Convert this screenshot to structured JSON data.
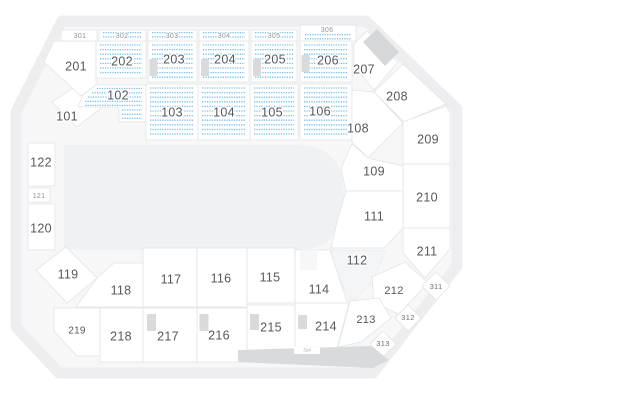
{
  "map": {
    "colors": {
      "page_background": "#ffffff",
      "ring_band": "#eeeef0",
      "interior": "#f7f7f8",
      "floor": "#f0f1f2",
      "section_fill": "#ffffff",
      "section_border": "#e3e4e6",
      "ghost_fill": "#f4f5f6",
      "available_dot": "#7bbfed",
      "tunnel": "#d8dadc",
      "stage_bar": "#d9dadb",
      "label_main": "#56585f",
      "label_small": "#8f9296",
      "label_diamond": "#6b6e74",
      "label_chip": "#9aa0a4"
    },
    "sections": [
      {
        "id": "101",
        "label": "101",
        "status": "standard"
      },
      {
        "id": "102",
        "label": "102",
        "status": "available"
      },
      {
        "id": "103",
        "label": "103",
        "status": "available"
      },
      {
        "id": "104",
        "label": "104",
        "status": "available"
      },
      {
        "id": "105",
        "label": "105",
        "status": "available"
      },
      {
        "id": "106",
        "label": "106",
        "status": "available"
      },
      {
        "id": "108",
        "label": "108",
        "status": "standard"
      },
      {
        "id": "109",
        "label": "109",
        "status": "standard"
      },
      {
        "id": "111",
        "label": "111",
        "status": "standard"
      },
      {
        "id": "112",
        "label": "112",
        "status": "standard"
      },
      {
        "id": "114",
        "label": "114",
        "status": "standard"
      },
      {
        "id": "115",
        "label": "115",
        "status": "standard"
      },
      {
        "id": "116",
        "label": "116",
        "status": "standard"
      },
      {
        "id": "117",
        "label": "117",
        "status": "standard"
      },
      {
        "id": "118",
        "label": "118",
        "status": "standard"
      },
      {
        "id": "119",
        "label": "119",
        "status": "standard"
      },
      {
        "id": "120",
        "label": "120",
        "status": "standard"
      },
      {
        "id": "121",
        "label": "121",
        "status": "standard"
      },
      {
        "id": "122",
        "label": "122",
        "status": "standard"
      },
      {
        "id": "201",
        "label": "201",
        "status": "standard"
      },
      {
        "id": "202",
        "label": "202",
        "status": "available"
      },
      {
        "id": "203",
        "label": "203",
        "status": "available"
      },
      {
        "id": "204",
        "label": "204",
        "status": "available"
      },
      {
        "id": "205",
        "label": "205",
        "status": "available"
      },
      {
        "id": "206",
        "label": "206",
        "status": "available"
      },
      {
        "id": "207",
        "label": "207",
        "status": "standard"
      },
      {
        "id": "208",
        "label": "208",
        "status": "standard"
      },
      {
        "id": "209",
        "label": "209",
        "status": "standard"
      },
      {
        "id": "210",
        "label": "210",
        "status": "standard"
      },
      {
        "id": "211",
        "label": "211",
        "status": "standard"
      },
      {
        "id": "212",
        "label": "212",
        "status": "standard"
      },
      {
        "id": "213",
        "label": "213",
        "status": "standard"
      },
      {
        "id": "214",
        "label": "214",
        "status": "standard"
      },
      {
        "id": "215",
        "label": "215",
        "status": "standard"
      },
      {
        "id": "216",
        "label": "216",
        "status": "standard"
      },
      {
        "id": "217",
        "label": "217",
        "status": "standard"
      },
      {
        "id": "218",
        "label": "218",
        "status": "standard"
      },
      {
        "id": "219",
        "label": "219",
        "status": "standard"
      },
      {
        "id": "301",
        "label": "301",
        "status": "standard"
      },
      {
        "id": "302",
        "label": "302",
        "status": "available"
      },
      {
        "id": "303",
        "label": "303",
        "status": "available"
      },
      {
        "id": "304",
        "label": "304",
        "status": "available"
      },
      {
        "id": "305",
        "label": "305",
        "status": "available"
      },
      {
        "id": "306",
        "label": "306",
        "status": "available"
      },
      {
        "id": "311",
        "label": "311",
        "status": "standard"
      },
      {
        "id": "312",
        "label": "312",
        "status": "standard"
      },
      {
        "id": "313",
        "label": "313",
        "status": "standard"
      },
      {
        "id": "314",
        "label": "314",
        "status": "standard"
      }
    ]
  }
}
